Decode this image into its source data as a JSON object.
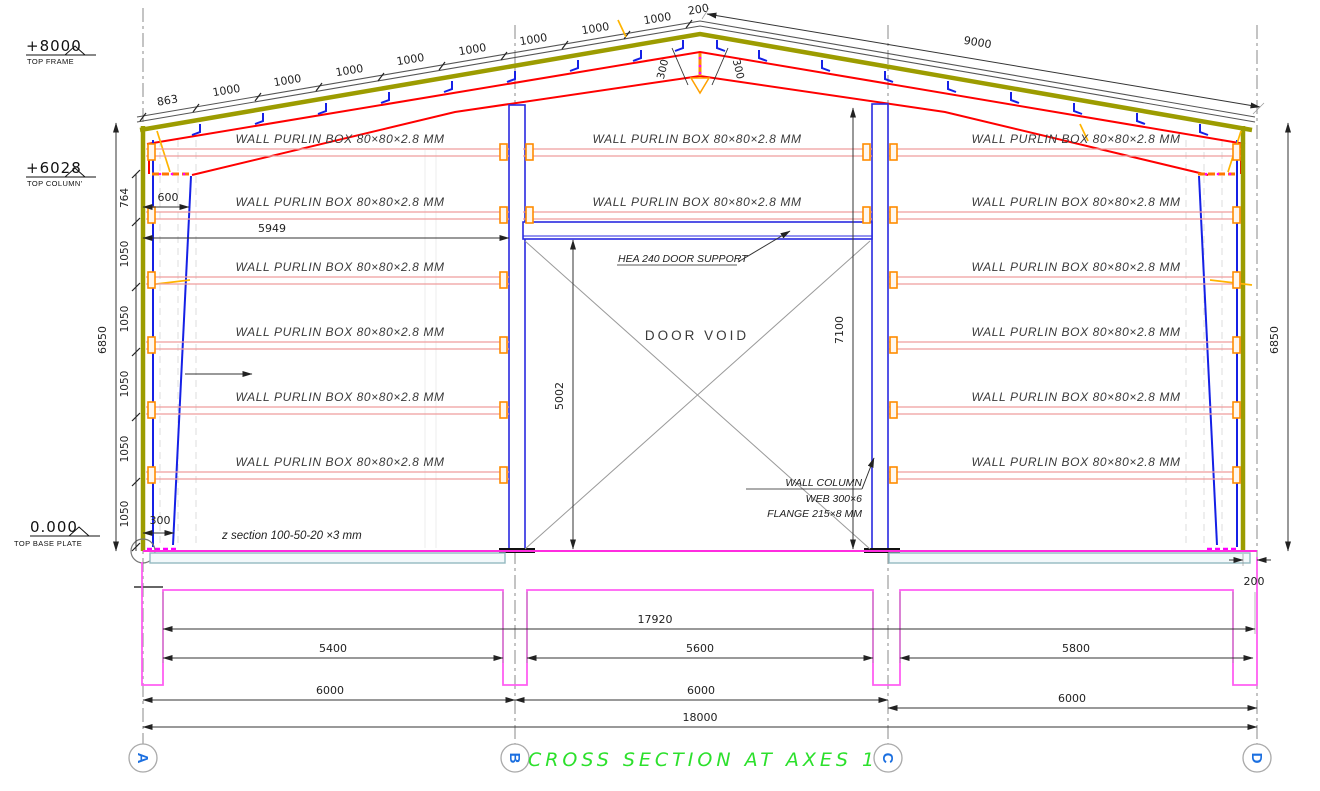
{
  "drawing_title": "CROSS SECTION AT AXES 1",
  "elevations": {
    "top_frame": {
      "value": "+8000",
      "label": "TOP FRAME"
    },
    "top_column": {
      "value": "+6028",
      "label": "TOP COLUMN'"
    },
    "top_base_plate": {
      "value": "0.000",
      "label": "TOP BASE PLATE"
    }
  },
  "roof_dims": {
    "left_spacings": [
      "863",
      "1000",
      "1000",
      "1000",
      "1000",
      "1000",
      "1000",
      "1000",
      "1000",
      "200"
    ],
    "ridge": [
      "300",
      "300"
    ],
    "right_slope_total": "9000"
  },
  "wall_dims": {
    "left_overall": "6850",
    "right_overall": "6850",
    "left_chain": [
      "764",
      "1050",
      "1050",
      "1050",
      "1050",
      "1050"
    ],
    "eave_offset": "600",
    "column_base_width": "300",
    "wall_to_door_column": "5949",
    "right_base_offset": "200"
  },
  "door": {
    "void_label": "DOOR VOID",
    "support_note": "HEA 240 DOOR SUPPORT",
    "clear_height": "5002",
    "column_height": "7100",
    "column_note": [
      "WALL COLUMN",
      "WEB 300×6",
      "FLANGE 215×8 MM"
    ]
  },
  "notes": {
    "purlin": "WALL PURLIN BOX 80×80×2.8 MM",
    "z_section": "z section 100-50-20 ×3 mm"
  },
  "foundation_dims": {
    "inner_span": "17920",
    "bays": [
      "5400",
      "5600",
      "5800"
    ],
    "axis_spans": [
      "6000",
      "6000",
      "6000"
    ],
    "overall": "18000"
  },
  "axes": [
    "A",
    "B",
    "C",
    "D"
  ],
  "colors": {
    "frame_red": "#ff0000",
    "column_blue": "#1520e6",
    "purlin_pink": "#ef9d9d",
    "cladding_olive": "#9c9c00",
    "connector_orange": "#ff8c00",
    "foundation_magenta": "#ff5ff2",
    "ground_magenta": "#ff2ce0",
    "title_green": "#2ce02c",
    "axis_letter_blue": "#1b6fe0",
    "sag_rod_yellow": "#ffb400"
  }
}
